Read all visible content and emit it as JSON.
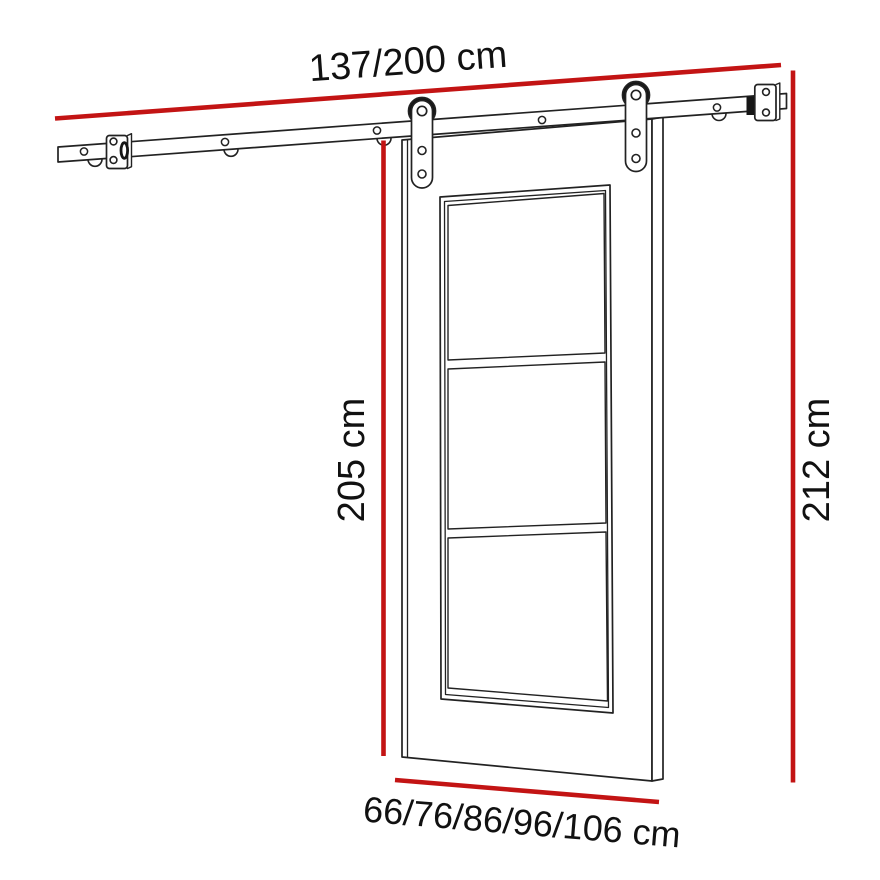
{
  "diagram": {
    "type": "technical-drawing",
    "subject": "sliding barn door with wall-mounted track hardware",
    "labels": {
      "track_width": "137/200 cm",
      "door_height": "205 cm",
      "overall_height": "212 cm",
      "door_width_options": "66/76/86/96/106 cm"
    },
    "colors": {
      "dimension_line": "#c31414",
      "drawing_line": "#222222",
      "background": "#ffffff"
    }
  }
}
